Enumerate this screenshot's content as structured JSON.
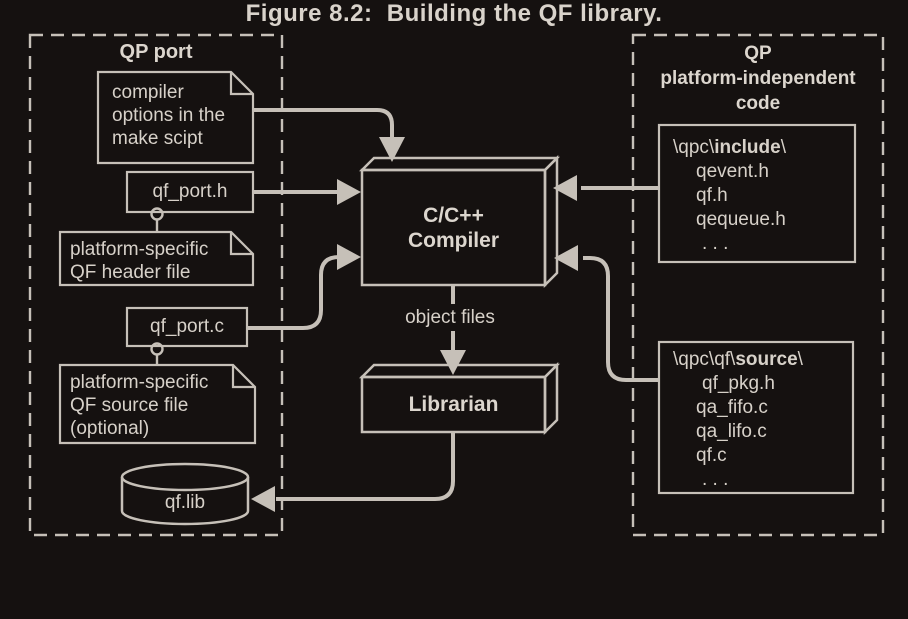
{
  "diagram": {
    "caption": "Figure 8.2:  Building the QF library.",
    "colors": {
      "background": "#151110",
      "stroke": "#c6c0b8",
      "text": "#d7d1c9"
    },
    "qp_port": {
      "title": "QP port",
      "compiler_options_note": {
        "lines": [
          "compiler",
          "options in the",
          "make scipt"
        ]
      },
      "qf_port_h_label": "qf_port.h",
      "header_note": {
        "lines": [
          "platform-specific",
          "QF header file"
        ]
      },
      "qf_port_c_label": "qf_port.c",
      "source_note": {
        "lines": [
          "platform-specific",
          "QF source file",
          "(optional)"
        ]
      },
      "qf_lib_label": "qf.lib"
    },
    "center": {
      "compiler": {
        "lines": [
          "C/C++",
          "Compiler"
        ]
      },
      "object_files_label": "object files",
      "librarian_label": "Librarian"
    },
    "qp_independent": {
      "title_lines": [
        "QP",
        "platform-independent",
        "code"
      ],
      "include_box": {
        "path_prefix": "\\qpc\\",
        "path_bold": "include",
        "path_suffix": "\\",
        "files": [
          "qevent.h",
          "qf.h",
          "qequeue.h",
          ". . ."
        ]
      },
      "source_box": {
        "path_prefix": "\\qpc\\qf\\",
        "path_bold": "source",
        "path_suffix": "\\",
        "files": [
          "qf_pkg.h",
          "qa_fifo.c",
          "qa_lifo.c",
          "qf.c",
          ". . ."
        ]
      }
    }
  }
}
